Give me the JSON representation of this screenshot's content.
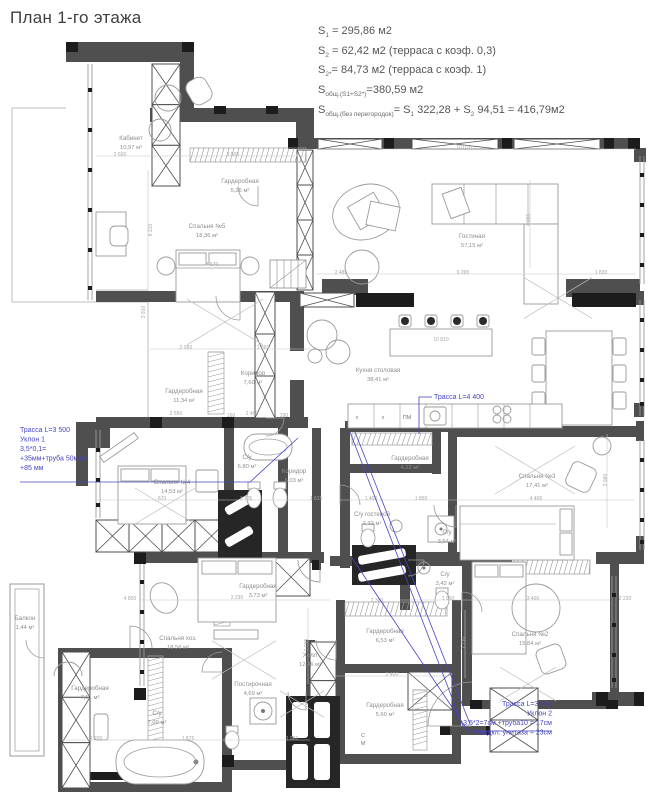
{
  "title": "План 1-го этажа",
  "colors": {
    "wall": "#4f4f4f",
    "black": "#1c1c1c",
    "line": "#9a9a9a",
    "faint": "#bdbdbd",
    "room_label": "#8d8d8d",
    "dim": "#a6a6a6",
    "blue": "#4745c4",
    "title": "#3f3f3f"
  },
  "area_summary": {
    "lines": [
      {
        "parts": [
          {
            "t": "S"
          },
          {
            "s": "1"
          },
          {
            "t": " = 295,86 м2"
          }
        ]
      },
      {
        "parts": [
          {
            "t": "S"
          },
          {
            "s": "2"
          },
          {
            "t": " = 62,42 м2 (терраса с коэф. 0,3)"
          }
        ]
      },
      {
        "parts": [
          {
            "t": "S"
          },
          {
            "s": "2*"
          },
          {
            "t": "= 84,73 м2 (терраса с коэф. 1)"
          }
        ]
      },
      {
        "parts": [
          {
            "t": "S"
          },
          {
            "s": "общ.(S1+S2*)"
          },
          {
            "t": "=380,59 м2"
          }
        ]
      },
      {
        "parts": [
          {
            "t": "S"
          },
          {
            "s": "общ.(без перегородок)"
          },
          {
            "t": "= S"
          },
          {
            "s": "1"
          },
          {
            "t": " 322,28 + S"
          },
          {
            "s": "2"
          },
          {
            "t": " 94,51 = 416,79м2"
          }
        ]
      }
    ]
  },
  "rooms": [
    {
      "name": "Кабинет",
      "area": "10,97 м²",
      "x": 131,
      "y": 140
    },
    {
      "name": "Гардеробная",
      "area": "5,26 м²",
      "x": 240,
      "y": 183
    },
    {
      "name": "Спальня №5",
      "area": "18,36 м²",
      "x": 207,
      "y": 228
    },
    {
      "name": "Гостиная",
      "area": "57,15 м²",
      "x": 472,
      "y": 238
    },
    {
      "name": "Кухня столовая",
      "area": "38,41 м²",
      "x": 378,
      "y": 372
    },
    {
      "name": "Гардеробная",
      "area": "11,34 м²",
      "x": 184,
      "y": 393
    },
    {
      "name": "Коридор",
      "area": "7,60 м²",
      "x": 253,
      "y": 375
    },
    {
      "name": "Спальня №4",
      "area": "14,53 м²",
      "x": 172,
      "y": 484
    },
    {
      "name": "С/у",
      "area": "6,80 м²",
      "x": 247,
      "y": 459
    },
    {
      "name": "Коридор",
      "area": "6,03 м²",
      "x": 294,
      "y": 473
    },
    {
      "name": "Гардеробная",
      "area": "4,22 м²",
      "x": 410,
      "y": 460
    },
    {
      "name": "С/у гостевой",
      "area": "2,32 м²",
      "x": 372,
      "y": 516
    },
    {
      "name": "Спальня №3",
      "area": "17,41 м²",
      "x": 537,
      "y": 478
    },
    {
      "name": "С/у",
      "area": "3,54 м²",
      "x": 447,
      "y": 534
    },
    {
      "name": "С/у",
      "area": "3,42 м²",
      "x": 445,
      "y": 576
    },
    {
      "name": "Спальня №2",
      "area": "15,84 м²",
      "x": 530,
      "y": 636
    },
    {
      "name": "Спальня хоз.",
      "area": "18,56 м²",
      "x": 178,
      "y": 640
    },
    {
      "name": "Гардеробная",
      "area": "3,73 м²",
      "x": 258,
      "y": 588
    },
    {
      "name": "Холл",
      "area": "12,46 м²",
      "x": 310,
      "y": 657
    },
    {
      "name": "Гардеробная",
      "area": "6,53 м²",
      "x": 385,
      "y": 633
    },
    {
      "name": "Гардеробная",
      "area": "5,60 м²",
      "x": 385,
      "y": 707
    },
    {
      "name": "Балкон",
      "area": "1,44 м²",
      "x": 25,
      "y": 620
    },
    {
      "name": "Гардеробная",
      "area": "7,51 м²",
      "x": 90,
      "y": 690
    },
    {
      "name": "Постирочная",
      "area": "4,69 м²",
      "x": 253,
      "y": 686
    },
    {
      "name": "С/у",
      "area": "7,09 м²",
      "x": 157,
      "y": 715
    }
  ],
  "annotations": [
    {
      "x": 20,
      "y": 432,
      "align": "start",
      "lines": [
        "Трасса L=3 500",
        "Уклон 1",
        "3,5*0,1=",
        "+35мм+труба 50мм=",
        "+85 мм"
      ]
    },
    {
      "x": 434,
      "y": 399,
      "align": "start",
      "lines": [
        "Трасса L=4 400"
      ]
    },
    {
      "x": 552,
      "y": 706,
      "align": "end",
      "lines": [
        "Трасса L=3 000",
        "Уклон 2",
        "3,5*2=7см +труба10 = 17см",
        "Н подкл. унитаза = 23см"
      ]
    }
  ],
  "dimensions": [
    {
      "t": "2 600",
      "x": 120,
      "y": 156
    },
    {
      "t": "3 505",
      "x": 233,
      "y": 156
    },
    {
      "t": "10 020",
      "x": 464,
      "y": 149
    },
    {
      "t": "8 310",
      "x": 152,
      "y": 230,
      "v": true
    },
    {
      "t": "4 670",
      "x": 212,
      "y": 266
    },
    {
      "t": "2 950",
      "x": 186,
      "y": 349
    },
    {
      "t": "1 860",
      "x": 263,
      "y": 349
    },
    {
      "t": "3 910",
      "x": 145,
      "y": 312,
      "v": true
    },
    {
      "t": "2 485",
      "x": 341,
      "y": 274
    },
    {
      "t": "6 295",
      "x": 463,
      "y": 274
    },
    {
      "t": "1 830",
      "x": 601,
      "y": 274
    },
    {
      "t": "4 655",
      "x": 530,
      "y": 220,
      "v": true
    },
    {
      "t": "10 810",
      "x": 441,
      "y": 341
    },
    {
      "t": "2 550",
      "x": 176,
      "y": 415
    },
    {
      "t": "2 460",
      "x": 252,
      "y": 415
    },
    {
      "t": "290",
      "x": 284,
      "y": 417
    },
    {
      "t": "160",
      "x": 231,
      "y": 417
    },
    {
      "t": "670",
      "x": 162,
      "y": 500
    },
    {
      "t": "1 705",
      "x": 246,
      "y": 500
    },
    {
      "t": "1 615",
      "x": 316,
      "y": 500
    },
    {
      "t": "1 400",
      "x": 371,
      "y": 500
    },
    {
      "t": "1 850",
      "x": 421,
      "y": 500
    },
    {
      "t": "4 400",
      "x": 536,
      "y": 500
    },
    {
      "t": "3 980",
      "x": 607,
      "y": 480,
      "v": true
    },
    {
      "t": "1 900",
      "x": 448,
      "y": 600
    },
    {
      "t": "3 400",
      "x": 533,
      "y": 600
    },
    {
      "t": "4 850",
      "x": 130,
      "y": 600
    },
    {
      "t": "2 230",
      "x": 237,
      "y": 599
    },
    {
      "t": "2 230",
      "x": 625,
      "y": 600
    },
    {
      "t": "2 360",
      "x": 377,
      "y": 602
    },
    {
      "t": "1 875",
      "x": 188,
      "y": 740
    },
    {
      "t": "1 960",
      "x": 292,
      "y": 740
    },
    {
      "t": "2 200",
      "x": 96,
      "y": 740
    },
    {
      "t": "2 400",
      "x": 392,
      "y": 676
    },
    {
      "t": "1 730",
      "x": 465,
      "y": 643,
      "v": true
    },
    {
      "t": "1 095",
      "x": 308,
      "y": 645,
      "v": true
    }
  ],
  "small_labels": [
    {
      "t": "х",
      "x": 357,
      "y": 419
    },
    {
      "t": "х",
      "x": 383,
      "y": 419
    },
    {
      "t": "ПМ",
      "x": 407,
      "y": 419
    },
    {
      "t": "С",
      "x": 363,
      "y": 737
    },
    {
      "t": "М",
      "x": 363,
      "y": 745
    }
  ]
}
